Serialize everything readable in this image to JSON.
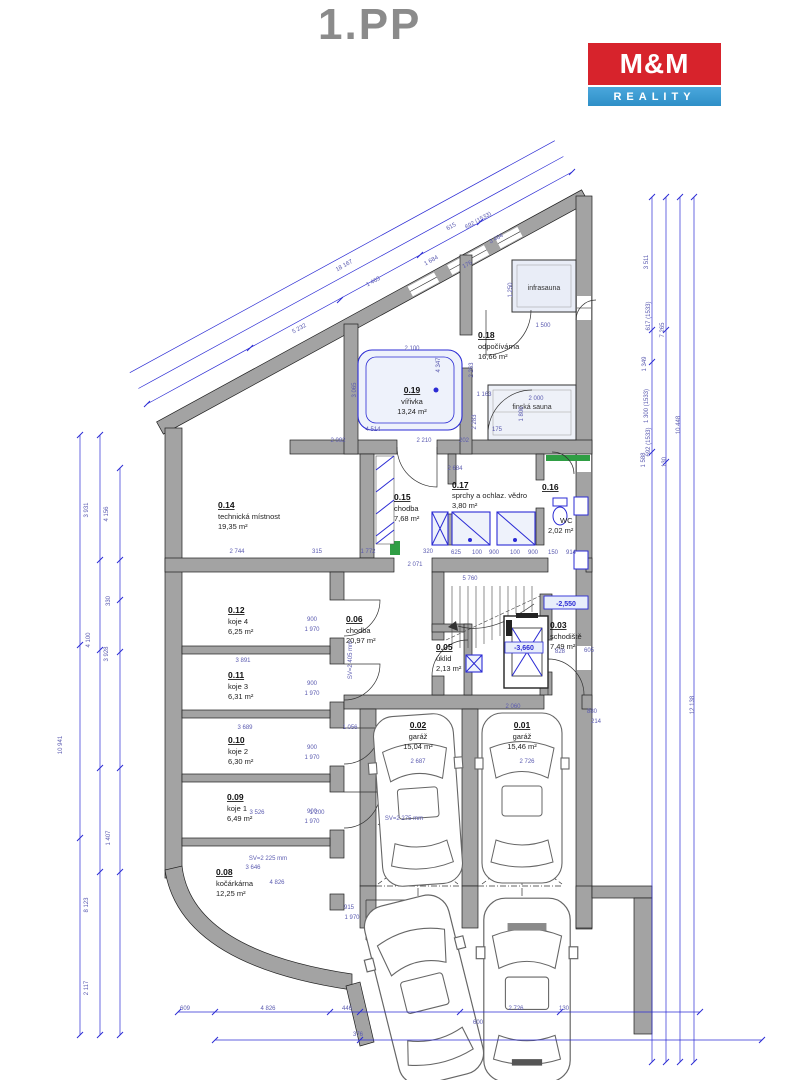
{
  "header": {
    "title": "1.PP"
  },
  "logo": {
    "line1": "M&M",
    "line2": "REALITY",
    "red": "#d7232c",
    "blue": "#2e8fc7"
  },
  "rooms": {
    "r01": {
      "num": "0.01",
      "name": "garáž",
      "area": "15,46 m²"
    },
    "r02": {
      "num": "0.02",
      "name": "garáž",
      "area": "15,04 m²"
    },
    "r03": {
      "num": "0.03",
      "name": "schodiště",
      "area": "7,49 m²"
    },
    "r05": {
      "num": "0.05",
      "name": "úklid",
      "area": "2,13 m²"
    },
    "r06": {
      "num": "0.06",
      "name": "chodba",
      "area": "20,97 m²"
    },
    "r08": {
      "num": "0.08",
      "name": "kočárkárna",
      "area": "12,25 m²"
    },
    "r09": {
      "num": "0.09",
      "name": "koje 1",
      "area": "6,49 m²"
    },
    "r10": {
      "num": "0.10",
      "name": "koje 2",
      "area": "6,30 m²"
    },
    "r11": {
      "num": "0.11",
      "name": "koje 3",
      "area": "6,31 m²"
    },
    "r12": {
      "num": "0.12",
      "name": "koje 4",
      "area": "6,25 m²"
    },
    "r14": {
      "num": "0.14",
      "name": "technická místnost",
      "area": "19,35 m²"
    },
    "r15": {
      "num": "0.15",
      "name": "chodba",
      "area": "7,68 m²"
    },
    "r16": {
      "num": "0.16",
      "name": "WC",
      "area": "2,02 m²"
    },
    "r17": {
      "num": "0.17",
      "name": "sprchy a ochlaz. vědro",
      "area": "3,80 m²"
    },
    "r18": {
      "num": "0.18",
      "name": "odpočívárna",
      "area": "16,66 m²"
    },
    "r19": {
      "num": "0.19",
      "name": "vířivka",
      "area": "13,24 m²"
    }
  },
  "labels": {
    "infrasauna": "infrasauna",
    "finska_sauna": "finská sauna",
    "level_stair": "-2,550",
    "level_lift": "-3,660"
  },
  "annotations": [
    [
      345,
      267,
      "18 167",
      -29
    ],
    [
      374,
      283,
      "1 463",
      -29
    ],
    [
      300,
      330,
      "5 232",
      -29
    ],
    [
      432,
      262,
      "1 684",
      -29
    ],
    [
      468,
      266,
      "176",
      -29
    ],
    [
      452,
      228,
      "615",
      -29
    ],
    [
      479,
      222,
      "692 (1533)",
      -29
    ],
    [
      497,
      240,
      "3 484",
      -29
    ],
    [
      88,
      510,
      "3 931",
      -90
    ],
    [
      108,
      514,
      "4 156",
      -90
    ],
    [
      110,
      601,
      "330",
      -90
    ],
    [
      90,
      640,
      "4 100",
      -90
    ],
    [
      108,
      654,
      "3 928",
      -90
    ],
    [
      62,
      745,
      "10 941",
      -90
    ],
    [
      88,
      905,
      "8 123",
      -90
    ],
    [
      88,
      988,
      "2 117",
      -90
    ],
    [
      110,
      838,
      "1 407",
      -90
    ],
    [
      648,
      262,
      "3 511",
      -90
    ],
    [
      650,
      316,
      "617 (1533)",
      -90
    ],
    [
      664,
      330,
      "7 265",
      -90
    ],
    [
      646,
      364,
      "1 349",
      -90
    ],
    [
      648,
      406,
      "1 300 (1533)",
      -90
    ],
    [
      650,
      442,
      "692 (1533)",
      -90
    ],
    [
      645,
      460,
      "1 588",
      -90
    ],
    [
      666,
      462,
      "130",
      -90
    ],
    [
      680,
      425,
      "10 448",
      -90
    ],
    [
      694,
      705,
      "12 138",
      -90
    ],
    [
      543,
      327,
      "1 500",
      0
    ],
    [
      512,
      290,
      "1 250",
      -90
    ],
    [
      484,
      396,
      "1 163",
      0
    ],
    [
      536,
      400,
      "2 000",
      0
    ],
    [
      523,
      414,
      "1 800",
      -90
    ],
    [
      412,
      350,
      "2 100",
      0
    ],
    [
      356,
      390,
      "3 065",
      -90
    ],
    [
      373,
      431,
      "4 514",
      0
    ],
    [
      497,
      431,
      "175",
      0
    ],
    [
      338,
      442,
      "2 092",
      0
    ],
    [
      424,
      442,
      "2 210",
      0
    ],
    [
      464,
      442,
      "202",
      0
    ],
    [
      455,
      470,
      "2 684",
      0
    ],
    [
      440,
      365,
      "4 347",
      -90
    ],
    [
      473,
      370,
      "2 263",
      -90
    ],
    [
      476,
      422,
      "2 283",
      -90
    ],
    [
      237,
      553,
      "2 744",
      0
    ],
    [
      317,
      553,
      "315",
      0
    ],
    [
      368,
      553,
      "1 772",
      0
    ],
    [
      428,
      553,
      "320",
      0
    ],
    [
      415,
      566,
      "2 071",
      0
    ],
    [
      456,
      554,
      "625",
      0
    ],
    [
      477,
      554,
      "100",
      0
    ],
    [
      494,
      554,
      "900",
      0
    ],
    [
      515,
      554,
      "100",
      0
    ],
    [
      533,
      554,
      "900",
      0
    ],
    [
      553,
      554,
      "150",
      0
    ],
    [
      571,
      554,
      "914",
      0
    ],
    [
      470,
      580,
      "5 760",
      0
    ],
    [
      243,
      662,
      "3 891",
      0
    ],
    [
      245,
      729,
      "3 689",
      0
    ],
    [
      257,
      814,
      "3 526",
      0
    ],
    [
      253,
      869,
      "3 646",
      0
    ],
    [
      277,
      884,
      "4 826",
      0
    ],
    [
      317,
      814,
      "1 200",
      0
    ],
    [
      350,
      729,
      "1 056",
      0
    ],
    [
      312,
      621,
      "900",
      0
    ],
    [
      312,
      631,
      "1 970",
      0
    ],
    [
      312,
      685,
      "900",
      0
    ],
    [
      312,
      695,
      "1 970",
      0
    ],
    [
      312,
      749,
      "900",
      0
    ],
    [
      312,
      759,
      "1 970",
      0
    ],
    [
      312,
      813,
      "900",
      0
    ],
    [
      312,
      823,
      "1 970",
      0
    ],
    [
      349,
      909,
      "915",
      0
    ],
    [
      352,
      919,
      "1 970",
      0
    ],
    [
      268,
      860,
      "SV=2 225 mm",
      0
    ],
    [
      404,
      820,
      "SV=2 275 mm",
      0
    ],
    [
      352,
      660,
      "SV=2 405 mm",
      -90
    ],
    [
      513,
      708,
      "2 060",
      0
    ],
    [
      592,
      713,
      "880",
      0
    ],
    [
      596,
      723,
      "214",
      0
    ],
    [
      418,
      763,
      "2 687",
      0
    ],
    [
      527,
      763,
      "2 726",
      0
    ],
    [
      560,
      653,
      "828",
      0
    ],
    [
      589,
      652,
      "605",
      0
    ],
    [
      185,
      1010,
      "609",
      0
    ],
    [
      268,
      1010,
      "4 826",
      0
    ],
    [
      347,
      1010,
      "446",
      0
    ],
    [
      358,
      1036,
      "376",
      0
    ],
    [
      478,
      1024,
      "600",
      0
    ],
    [
      516,
      1010,
      "2 726",
      0
    ],
    [
      564,
      1010,
      "130",
      0
    ]
  ]
}
